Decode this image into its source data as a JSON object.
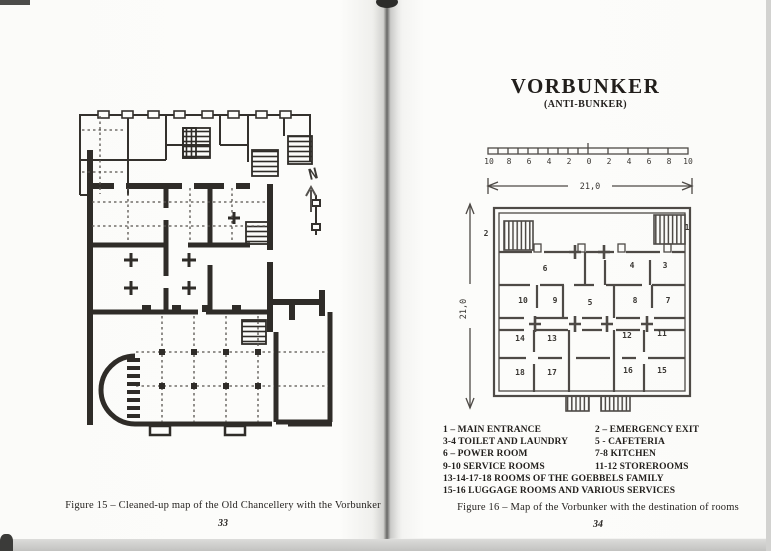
{
  "photo": {
    "paper_color": "#fcfcfa",
    "ink_color": "#2f2c28",
    "plan_line_color": "#4e4a46"
  },
  "left_page": {
    "north_label": "N",
    "figure_caption": "Figure  15 –  Cleaned-up map of the Old Chancellery with the Vorbunker",
    "page_number": "33"
  },
  "right_page": {
    "title": "VORBUNKER",
    "subtitle": "(ANTI-BUNKER)",
    "scale_ticks": [
      "10",
      "8",
      "6",
      "4",
      "2",
      "0",
      "2",
      "4",
      "6",
      "8",
      "10"
    ],
    "width_dimension": "21,0",
    "height_dimension": "21,0",
    "rooms": [
      "1",
      "2",
      "3",
      "4",
      "5",
      "6",
      "7",
      "8",
      "9",
      "10",
      "11",
      "12",
      "13",
      "14",
      "15",
      "16",
      "17",
      "18"
    ],
    "legend_rows": [
      {
        "left": "1 – MAIN ENTRANCE",
        "right": "2 – EMERGENCY EXIT"
      },
      {
        "left": "3-4 TOILET AND LAUNDRY",
        "right": "5 - CAFETERIA"
      },
      {
        "left": "6 – POWER ROOM",
        "right": "7-8  KITCHEN"
      },
      {
        "left": "9-10 SERVICE ROOMS",
        "right": "11-12 STOREROOMS"
      }
    ],
    "legend_full": [
      "13-14-17-18 ROOMS OF THE GOEBBELS FAMILY",
      "15-16 LUGGAGE ROOMS AND VARIOUS SERVICES"
    ],
    "figure_caption": "Figure  16 –  Map of the Vorbunker with the destination of rooms",
    "page_number": "34"
  }
}
